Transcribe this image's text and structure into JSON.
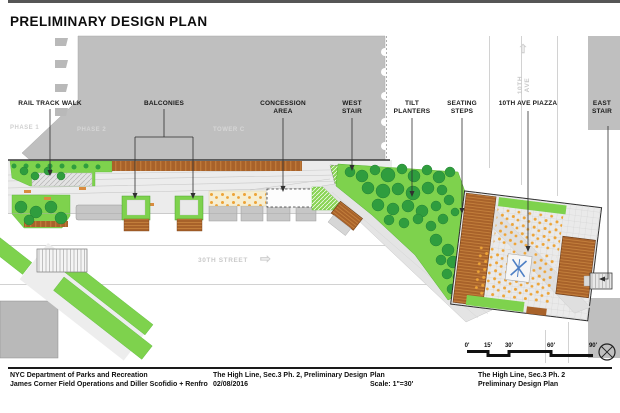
{
  "title": "PRELIMINARY DESIGN PLAN",
  "callouts": [
    {
      "id": "rail-track-walk",
      "text": "RAIL TRACK WALK"
    },
    {
      "id": "balconies",
      "text": "BALCONIES"
    },
    {
      "id": "concession-area",
      "text": "CONCESSION\nAREA"
    },
    {
      "id": "west-stair",
      "text": "WEST\nSTAIR"
    },
    {
      "id": "tilt-planters",
      "text": "TILT\nPLANTERS"
    },
    {
      "id": "seating-steps",
      "text": "SEATING\nSTEPS"
    },
    {
      "id": "tenth-ave-piazza",
      "text": "10TH AVE PIAZZA"
    },
    {
      "id": "east-stair",
      "text": "EAST\nSTAIR"
    }
  ],
  "plan": {
    "phase1": "PHASE 1",
    "phase2": "PHASE 2",
    "tower_c": "TOWER C",
    "street_30th": "30TH STREET",
    "ave_10th": "10TH AVE"
  },
  "icons": {
    "street_arrow_right": "⇨",
    "street_arrow_up": "⇧"
  },
  "scale_bar": {
    "ticks": [
      "0'",
      "15'",
      "30'",
      "60'",
      "90'"
    ]
  },
  "footer": {
    "col1": [
      "NYC Department of Parks and Recreation",
      "James Corner Field Operations and Diller Scofidio + Renfro"
    ],
    "col2": [
      "The High Line, Sec.3 Ph. 2, Preliminary Design",
      "02/08/2016"
    ],
    "col3": [
      "Plan",
      "Scale: 1\"=30'"
    ],
    "col4": [
      "The High Line, Sec.3 Ph. 2",
      "Preliminary Design Plan"
    ]
  },
  "colors": {
    "building_gray": "#bfbfbf",
    "paving_gray": "#ececec",
    "lawn_green": "#7ed24d",
    "tree_green": "#2f9d3e",
    "deck_brown": "#a8622a",
    "chair_orange": "#eda437",
    "feature_blue": "#4d7fc4"
  }
}
